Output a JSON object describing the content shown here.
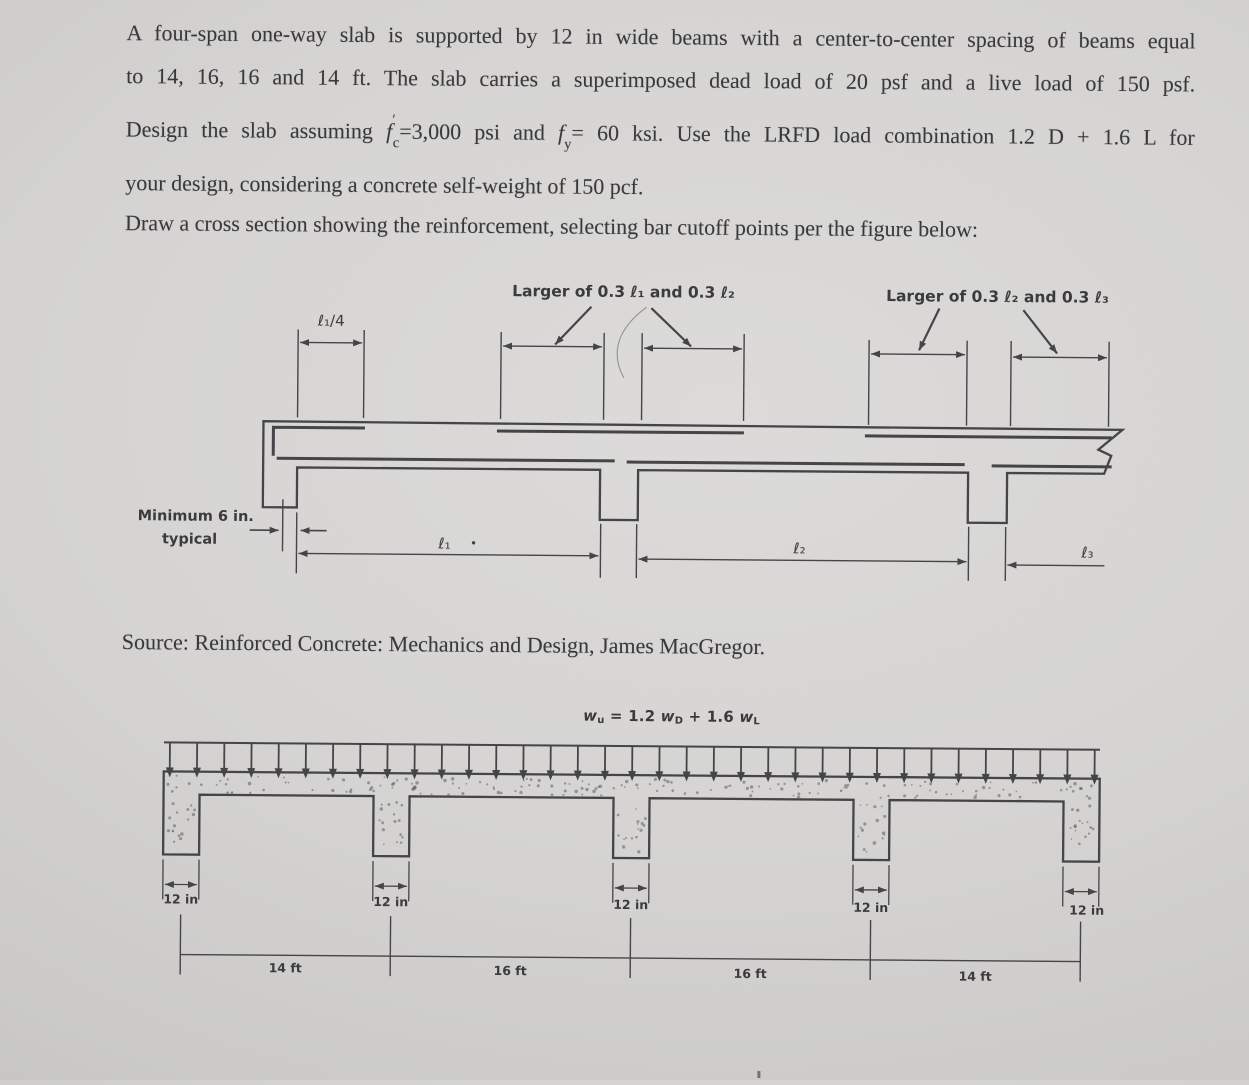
{
  "doc": {
    "paragraph1_lines": [
      [
        {
          "t": "A four-span one-way slab is supported by 12 in wide beams with a center-to-center spacing of beams equal"
        }
      ],
      [
        {
          "t": "to 14, 16, 16 and 14 ft. The slab carries a superimposed dead load of 20 psf and a live load of 150 psf."
        }
      ],
      [
        {
          "t": "Design the slab assuming "
        },
        {
          "t": "f",
          "i": true
        },
        {
          "t": "′",
          "sup": true
        },
        {
          "t": "c",
          "sub": true
        },
        {
          "t": "=3,000 psi and "
        },
        {
          "t": "f",
          "i": true
        },
        {
          "t": "y",
          "sub": true
        },
        {
          "t": "= 60 ksi. Use the LRFD load combination 1.2 D + 1.6 L for"
        }
      ],
      [
        {
          "t": "your design, considering a concrete self-weight of 150 pcf."
        }
      ]
    ],
    "paragraph2": [
      [
        {
          "t": "Draw a cross section showing the reinforcement, selecting bar cutoff points per the figure below:"
        }
      ]
    ],
    "source_line": [
      [
        {
          "t": "Source: Reinforced Concrete: Mechanics and Design, James MacGregor."
        }
      ]
    ],
    "figure_cutoff": {
      "label_cutoff_left": "Larger of 0.3 ℓ₁ and 0.3 ℓ₂",
      "label_cutoff_right": "Larger of 0.3 ℓ₂ and 0.3 ℓ₃",
      "dim_quarter_span": "ℓ₁/4",
      "min_note_line1": "Minimum 6 in.",
      "min_note_line2": "typical",
      "span1_label": "ℓ₁",
      "span2_label": "ℓ₂",
      "span3_label": "ℓ₃"
    },
    "figure_load": {
      "load_formula": [
        {
          "t": "w",
          "i": true
        },
        {
          "t": "u",
          "sub": true
        },
        {
          "t": " = 1.2 "
        },
        {
          "t": "w",
          "i": true
        },
        {
          "t": "D",
          "sub": true
        },
        {
          "t": " + 1.6 "
        },
        {
          "t": "w",
          "i": true
        },
        {
          "t": "L",
          "sub": true
        }
      ],
      "beam_width_labels": [
        "12 in",
        "12 in",
        "12 in",
        "12 in",
        "12 in"
      ],
      "span_labels": [
        "14 ft",
        "16 ft",
        "16 ft",
        "14 ft"
      ]
    },
    "colors": {
      "ink": "#39383b",
      "line": "#454448",
      "paper": "#d5d4d2"
    }
  }
}
